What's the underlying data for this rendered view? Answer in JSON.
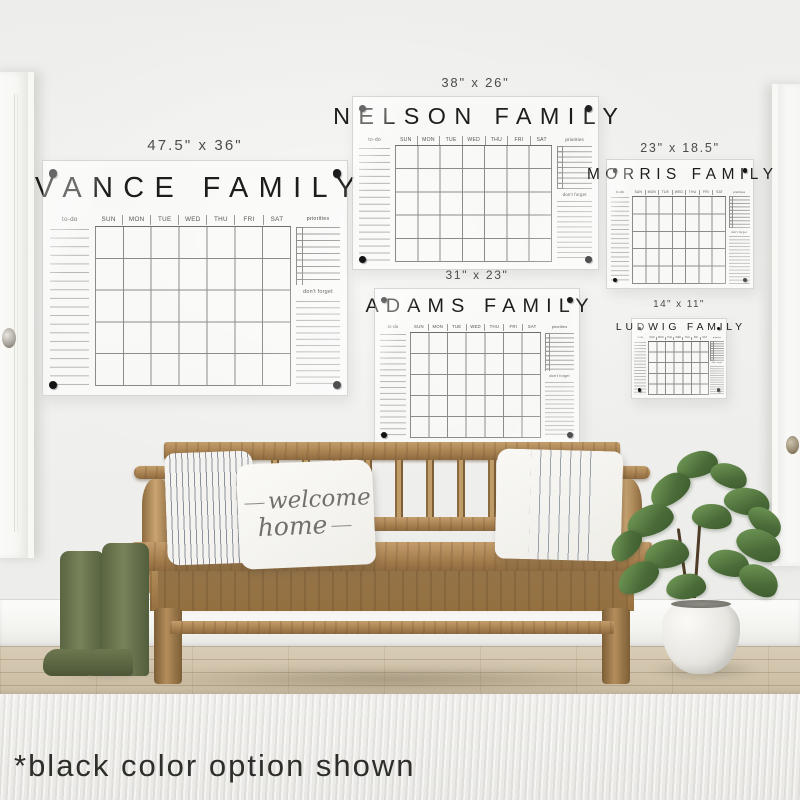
{
  "note": {
    "text": "*black color option shown"
  },
  "pillow": {
    "line1": "welcome",
    "line2": "home"
  },
  "calendar_common": {
    "days": [
      "SUN",
      "MON",
      "TUE",
      "WED",
      "THU",
      "FRI",
      "SAT"
    ],
    "todo_label": "to-do",
    "priorities_label": "priorities",
    "dont_forget_label": "don't forget"
  },
  "calendars": [
    {
      "name": "VANCE FAMILY",
      "size": "47.5\" x 36\""
    },
    {
      "name": "NELSON FAMILY",
      "size": "38\" x 26\""
    },
    {
      "name": "MORRIS FAMILY",
      "size": "23\" x 18.5\""
    },
    {
      "name": "ADAMS FAMILY",
      "size": "31\" x 23\""
    },
    {
      "name": "LUDWIG FAMILY",
      "size": "14\" x 11\""
    }
  ],
  "colors": {
    "calendar_marking": "#141414",
    "wall": "#f0f0ee",
    "bench_wood": "#a67f4f",
    "boots": "#68734c",
    "plant": "#4b6c39",
    "rug": "#edecE9"
  }
}
